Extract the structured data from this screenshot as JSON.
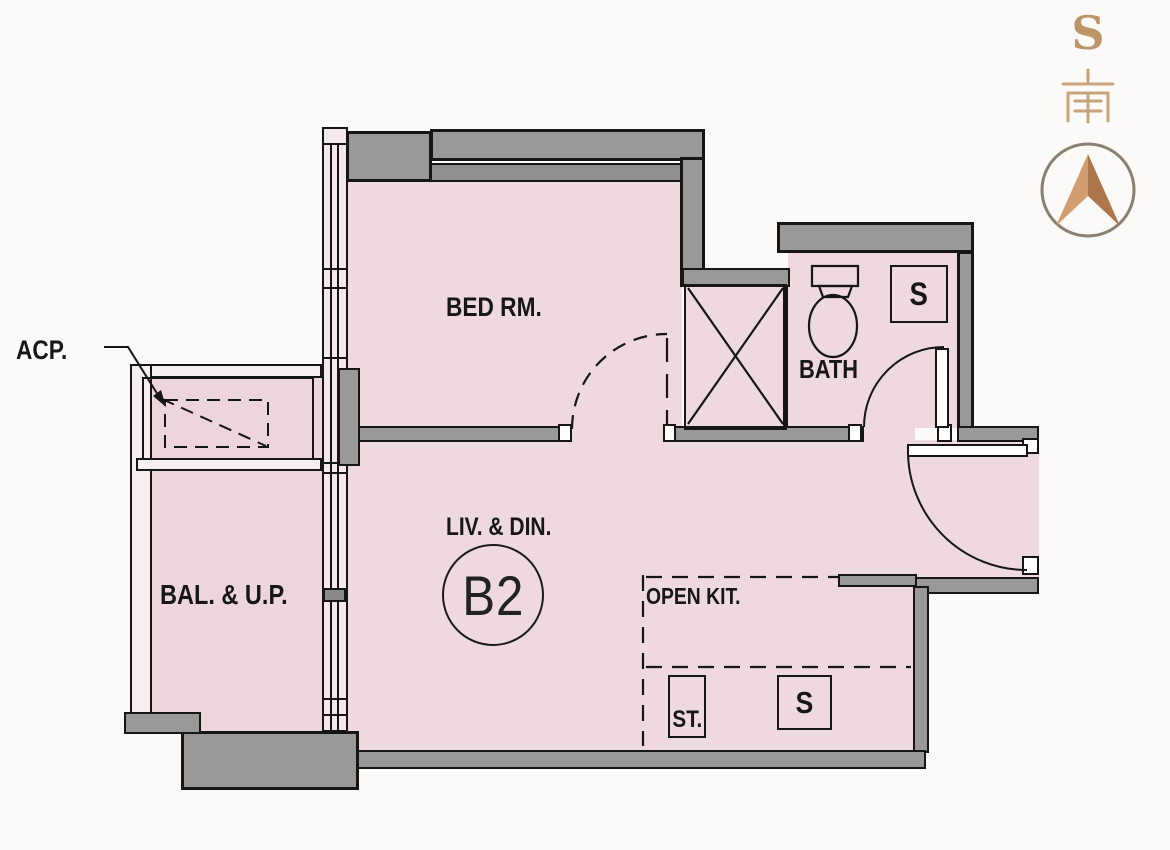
{
  "plan": {
    "unit_code": "B2",
    "labels": {
      "bedroom": "BED RM.",
      "living_dining": "LIV. & DIN.",
      "bath": "BATH",
      "balcony_utility": "BAL. & U.P.",
      "open_kitchen": "OPEN KIT.",
      "storage": "ST.",
      "sink_bath": "S",
      "sink_kitchen": "S",
      "ac_platform": "ACP."
    },
    "compass": {
      "direction_letter": "S",
      "direction_hanzi": "南"
    },
    "colors": {
      "floor_pink": "#eed9df",
      "balcony_pink": "#ecd6dc",
      "wall_gray": "#9a999a",
      "outline_black": "#161616",
      "compass_bronze": "#b9805a",
      "compass_ring": "#8b8172",
      "compass_text": "#bd9566"
    }
  }
}
